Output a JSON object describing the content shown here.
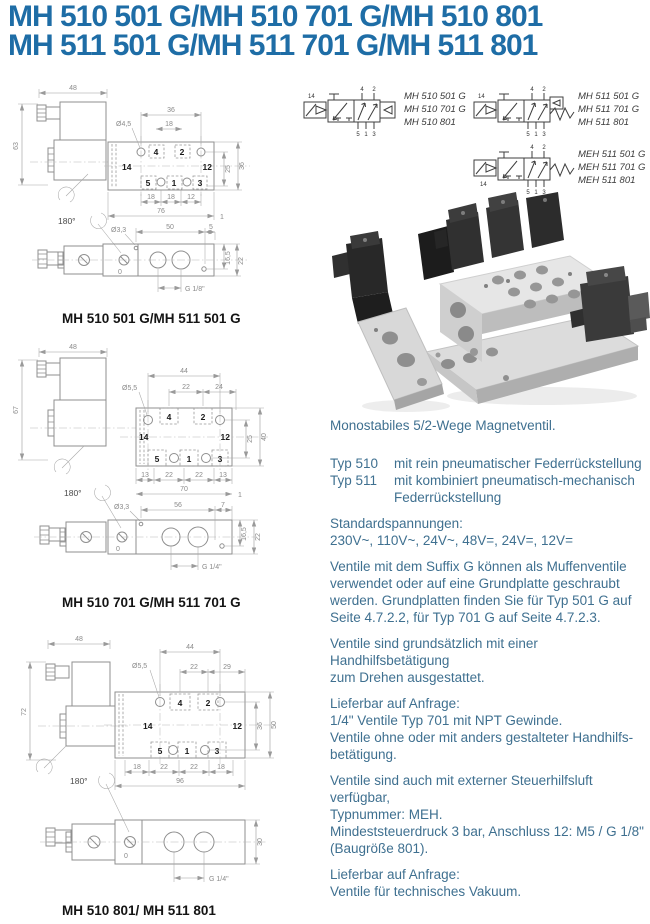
{
  "page": {
    "title_line1": "MH 510 501 G/MH 510 701 G/MH 510 801",
    "title_line2": "MH 511 501 G/MH 511 701 G/MH 511 801"
  },
  "ports": {
    "p4": "4",
    "p2": "2",
    "p5": "5",
    "p1": "1",
    "p3": "3",
    "p14": "14",
    "p12": "12"
  },
  "symbols": {
    "groups": [
      {
        "models": [
          "MH 510 501 G",
          "MH 510 701 G",
          "MH 510 801"
        ]
      },
      {
        "models": [
          "MH 511 501 G",
          "MH 511 701 G",
          "MH 511 801"
        ]
      },
      {
        "models": [
          "MEH 511 501 G",
          "MEH 511 701 G",
          "MEH 511 801"
        ]
      }
    ]
  },
  "drawings": [
    {
      "caption": "MH 510 501 G/MH 511 501 G",
      "dims": {
        "coil_width": "48",
        "height": "63",
        "rotate": "180°",
        "hole_span": "36",
        "hole_dia": "Ø4,5",
        "port_pitch": "18",
        "v1": "25",
        "v2": "36",
        "b1": "18",
        "b2": "18",
        "b3": "12",
        "overall": "76",
        "edge": "1",
        "side_hole": "Ø3,3",
        "override": "0",
        "s1": "50",
        "s2": "5",
        "sv1": "16,5",
        "sv2": "22",
        "thread": "G 1/8\""
      }
    },
    {
      "caption": "MH 510 701 G/MH 511 701 G",
      "dims": {
        "coil_width": "48",
        "height": "67",
        "rotate": "180°",
        "hole_span": "44",
        "hole_dia": "Ø5,5",
        "port_pitch": "22",
        "pitch2": "24",
        "v1": "25",
        "v2": "40",
        "b1": "13",
        "b2": "22",
        "b3": "22",
        "b4": "13",
        "overall": "70",
        "edge": "1",
        "side_hole": "Ø3,3",
        "override": "0",
        "s1": "56",
        "s2": "7",
        "sv1": "16,5",
        "sv2": "22",
        "thread": "G 1/4\""
      }
    },
    {
      "caption": "MH 510 801/ MH 511 801",
      "dims": {
        "coil_width": "48",
        "height": "72",
        "rotate": "180°",
        "hole_span": "44",
        "hole_dia": "Ø5,5",
        "port_pitch": "22",
        "pitch2": "29",
        "v1": "36",
        "v2": "50",
        "b1": "18",
        "b2": "22",
        "b3": "22",
        "b4": "18",
        "overall": "96",
        "override": "0",
        "sv1": "30",
        "thread": "G 1/4\""
      }
    }
  ],
  "info": {
    "intro": "Monostabiles 5/2-Wege Magnetventil.",
    "types": [
      {
        "name": "Typ 510",
        "desc": "mit rein pneumatischer Federrückstellung"
      },
      {
        "name": "Typ 511",
        "desc": "mit kombiniert pneumatisch-mechanisch",
        "desc2": "Federrückstellung"
      }
    ],
    "volt_label": "Standardspannungen:",
    "volt_values": "230V~, 110V~, 24V~, 48V=, 24V=, 12V=",
    "para_g": [
      "Ventile mit dem Suffix G können als Muffenventile",
      "verwendet oder auf eine Grundplatte geschraubt",
      "werden. Grundplatten finden Sie für Typ 501 G auf",
      "Seite 4.7.2.2, für Typ 701 G auf Seite 4.7.2.3."
    ],
    "para_hand": [
      "Ventile sind grundsätzlich mit einer Handhilfsbetätigung",
      "zum Drehen ausgestattet."
    ],
    "avail1": [
      "Lieferbar auf Anfrage:",
      "1/4\" Ventile Typ 701 mit NPT Gewinde.",
      "Ventile ohne oder mit anders gestalteter Handhilfs-",
      "betätigung."
    ],
    "para_meh": [
      "Ventile sind auch mit externer Steuerhilfsluft verfügbar,",
      "Typnummer: MEH.",
      "Mindeststeuerdruck 3 bar, Anschluss 12: M5 / G 1/8\"",
      "(Baugröße 801)."
    ],
    "avail2": [
      "Lieferbar auf Anfrage:",
      "Ventile für technisches Vakuum."
    ]
  }
}
